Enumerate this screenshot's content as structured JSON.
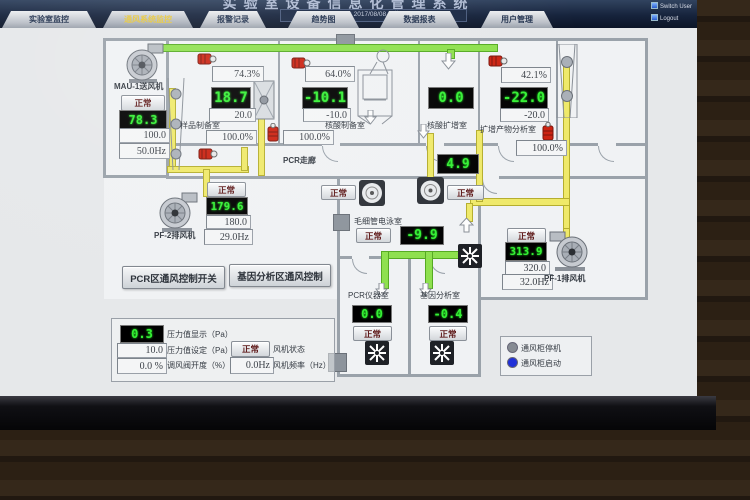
{
  "window": {
    "title": "实验室设备信息化管理系统",
    "time_label": "Current Time:",
    "time_value": "2017/08/08  星期二  13:12:28",
    "switch_user": "Switch User",
    "logout": "Logout"
  },
  "tabs": [
    {
      "label": "实验室监控"
    },
    {
      "label": "通风系统监控"
    },
    {
      "label": "报警记录"
    },
    {
      "label": "趋势图"
    },
    {
      "label": "数据报表"
    },
    {
      "label": "用户管理"
    }
  ],
  "fans": {
    "mau1": {
      "name": "MAU-1送风机",
      "status": "正常",
      "pressure": "78.3",
      "setpoint": "100.0",
      "frequency": "50.0Hz"
    },
    "pf2": {
      "name": "PF-2排风机",
      "status": "正常",
      "pressure": "179.6",
      "setpoint": "180.0",
      "frequency": "29.0Hz"
    },
    "pf1": {
      "name": "PF-1排风机",
      "status": "正常",
      "pressure": "313.9",
      "setpoint": "320.0",
      "frequency": "32.0Hz"
    }
  },
  "rooms": {
    "sample_prep": {
      "name": "样品制备室",
      "supply_damper": "74.3%",
      "pressure": "18.7",
      "setpoint": "20.0",
      "exhaust_damper": "100.0%"
    },
    "nucleic_prep": {
      "name": "核酸制备室",
      "supply_damper": "64.0%",
      "pressure": "-10.1",
      "setpoint": "-10.0",
      "exhaust_damper": "100.0%"
    },
    "amplification": {
      "name": "核酸扩增室",
      "pressure": "0.0"
    },
    "product_analysis": {
      "name": "扩增产物分析室",
      "supply_damper": "42.1%",
      "pressure": "-22.0",
      "setpoint": "-20.0",
      "exhaust_damper": "100.0%"
    },
    "corridor": {
      "name": "PCR走廊",
      "pressure": "4.9",
      "fan1_status": "正常",
      "fan2_status": "正常"
    },
    "capillary": {
      "name": "毛细管电泳室",
      "pressure": "-9.9",
      "status": "正常"
    },
    "pcr_instrument": {
      "name": "PCR仪器室",
      "pressure": "0.0",
      "status": "正常"
    },
    "gene_analysis": {
      "name": "基因分析室",
      "pressure": "-0.4",
      "status": "正常"
    }
  },
  "controls": {
    "pcr_switch": "PCR区通风控制开关",
    "gene_switch": "基因分析区通风控制"
  },
  "panel": {
    "pressure_value": "0.3",
    "pressure_label": "压力值显示（Pa）",
    "setpoint_value": "10.0",
    "setpoint_label": "压力值设定（Pa）",
    "damper_value": "0.0 %",
    "damper_label": "调风阀开度（%）",
    "fan_status": "正常",
    "fan_status_label": "风机状态",
    "frequency_value": "0.0Hz",
    "frequency_label": "风机频率（Hz）"
  },
  "legend": {
    "stopped": "通风柜停机",
    "running": "通风柜启动",
    "stopped_color": "#868b93",
    "running_color": "#2030d8"
  }
}
